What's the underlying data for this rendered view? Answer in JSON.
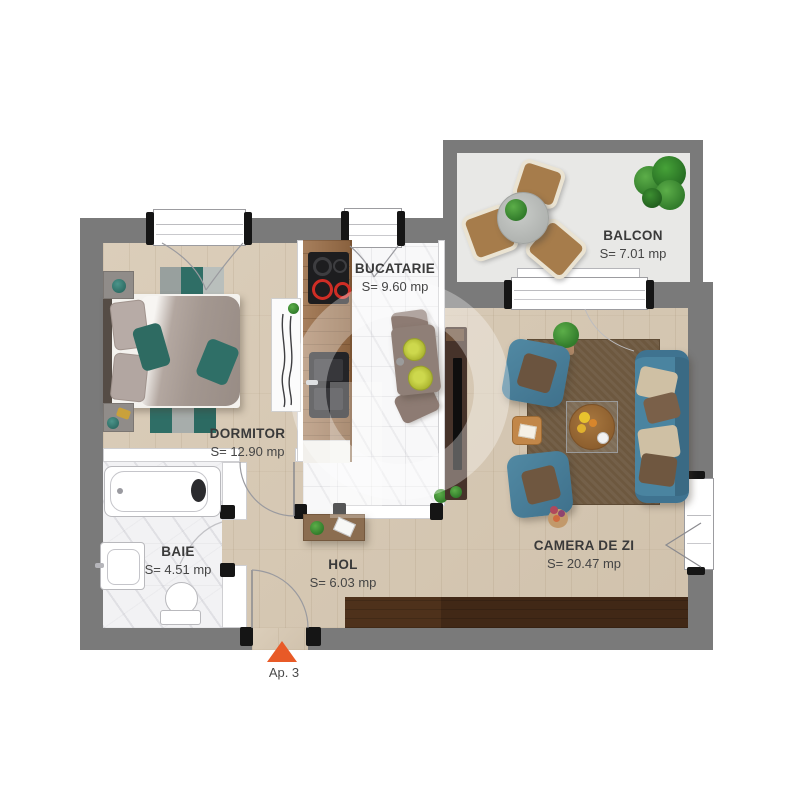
{
  "plan": {
    "apartment_label": "Ap. 3",
    "rooms": [
      {
        "id": "dormitor",
        "name": "DORMITOR",
        "area": "S= 12.90 mp"
      },
      {
        "id": "bucatarie",
        "name": "BUCATARIE",
        "area": "S= 9.60 mp"
      },
      {
        "id": "baie",
        "name": "BAIE",
        "area": "S= 4.51 mp"
      },
      {
        "id": "hol",
        "name": "HOL",
        "area": "S= 6.03 mp"
      },
      {
        "id": "camera_de_zi",
        "name": "CAMERA DE ZI",
        "area": "S= 20.47 mp"
      },
      {
        "id": "balcon",
        "name": "BALCON",
        "area": "S= 7.01 mp"
      }
    ],
    "entrance": {
      "marker": "triangle-up",
      "color": "#E85A27"
    },
    "colors": {
      "wall": "#7A7A7A",
      "wood_floor": "#D7C8B2",
      "teal_furniture": "#46809B",
      "accent_orange": "#E85A27",
      "balcony_floor": "#E8E8E6"
    }
  }
}
